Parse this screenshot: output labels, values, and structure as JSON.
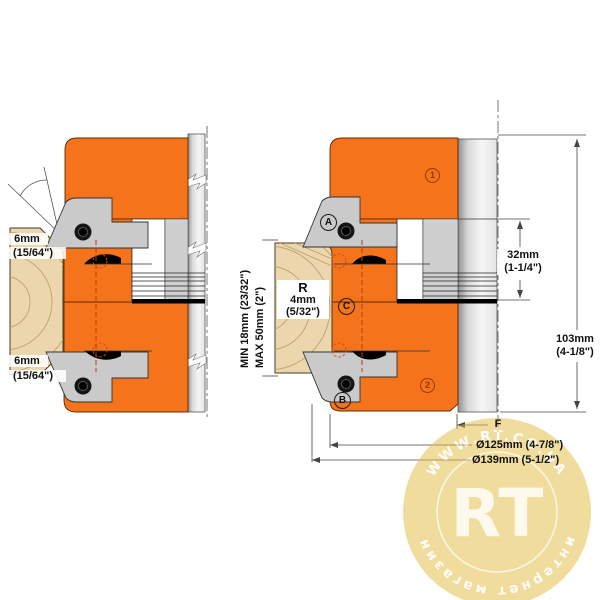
{
  "left_diagram": {
    "top_chamfer": {
      "value": "6mm",
      "fraction": "(15/64\")"
    },
    "bottom_chamfer": {
      "value": "6mm",
      "fraction": "(15/64\")"
    }
  },
  "right_diagram": {
    "callouts": {
      "a": "A",
      "b": "B",
      "c": "C",
      "pos1": "1",
      "pos2": "2"
    },
    "radius_label": {
      "r": "R",
      "value": "4mm",
      "fraction": "(5/32\")"
    },
    "stock_range": {
      "min": "MIN 18mm (23/32\")",
      "max": "MAX 50mm (2\")"
    },
    "dims": {
      "bore_section": {
        "value": "32mm",
        "fraction": "(1-1/4\")"
      },
      "overall": {
        "value": "103mm",
        "fraction": "(4-1/8\")"
      },
      "f": "F",
      "diameter_min": "Ø125mm (4-7/8\")",
      "diameter_max": "Ø139mm (5-1/2\")"
    }
  },
  "watermark": {
    "top_text": "WWW.RT.CO.UA",
    "initials": "RT",
    "bottom_text": "интернет магазин"
  },
  "colors": {
    "body_orange": "#F5731A",
    "steel_gray": "#CFCFCF",
    "wood_tan": "#EBD6AE",
    "watermark_gold": "#E3BC3F",
    "hidden_line_red": "#A84018"
  }
}
